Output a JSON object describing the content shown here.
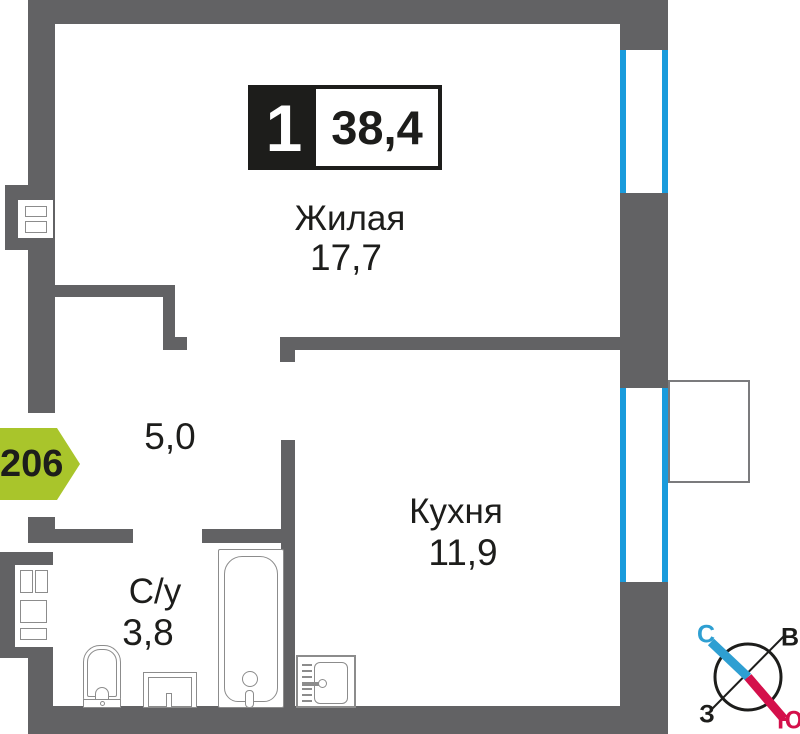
{
  "badge": {
    "rooms_count": "1",
    "total_area": "38,4"
  },
  "entrance": {
    "apartment_number": "206"
  },
  "rooms": {
    "living": {
      "name": "Жилая",
      "area": "17,7"
    },
    "kitchen": {
      "name": "Кухня",
      "area": "11,9"
    },
    "bathroom": {
      "name": "С/у",
      "area": "3,8"
    },
    "hallway": {
      "area": "5,0"
    }
  },
  "compass": {
    "north": "С",
    "east": "В",
    "west": "З",
    "south": "Ю"
  },
  "colors": {
    "wall": "#626264",
    "window_frame": "#199bdc",
    "entrance_arrow": "#a9c52b",
    "compass_north": "#2e9fd2",
    "compass_south": "#d4104b",
    "ink": "#1d1d1b",
    "fixture_outline": "#8c8c8c"
  }
}
